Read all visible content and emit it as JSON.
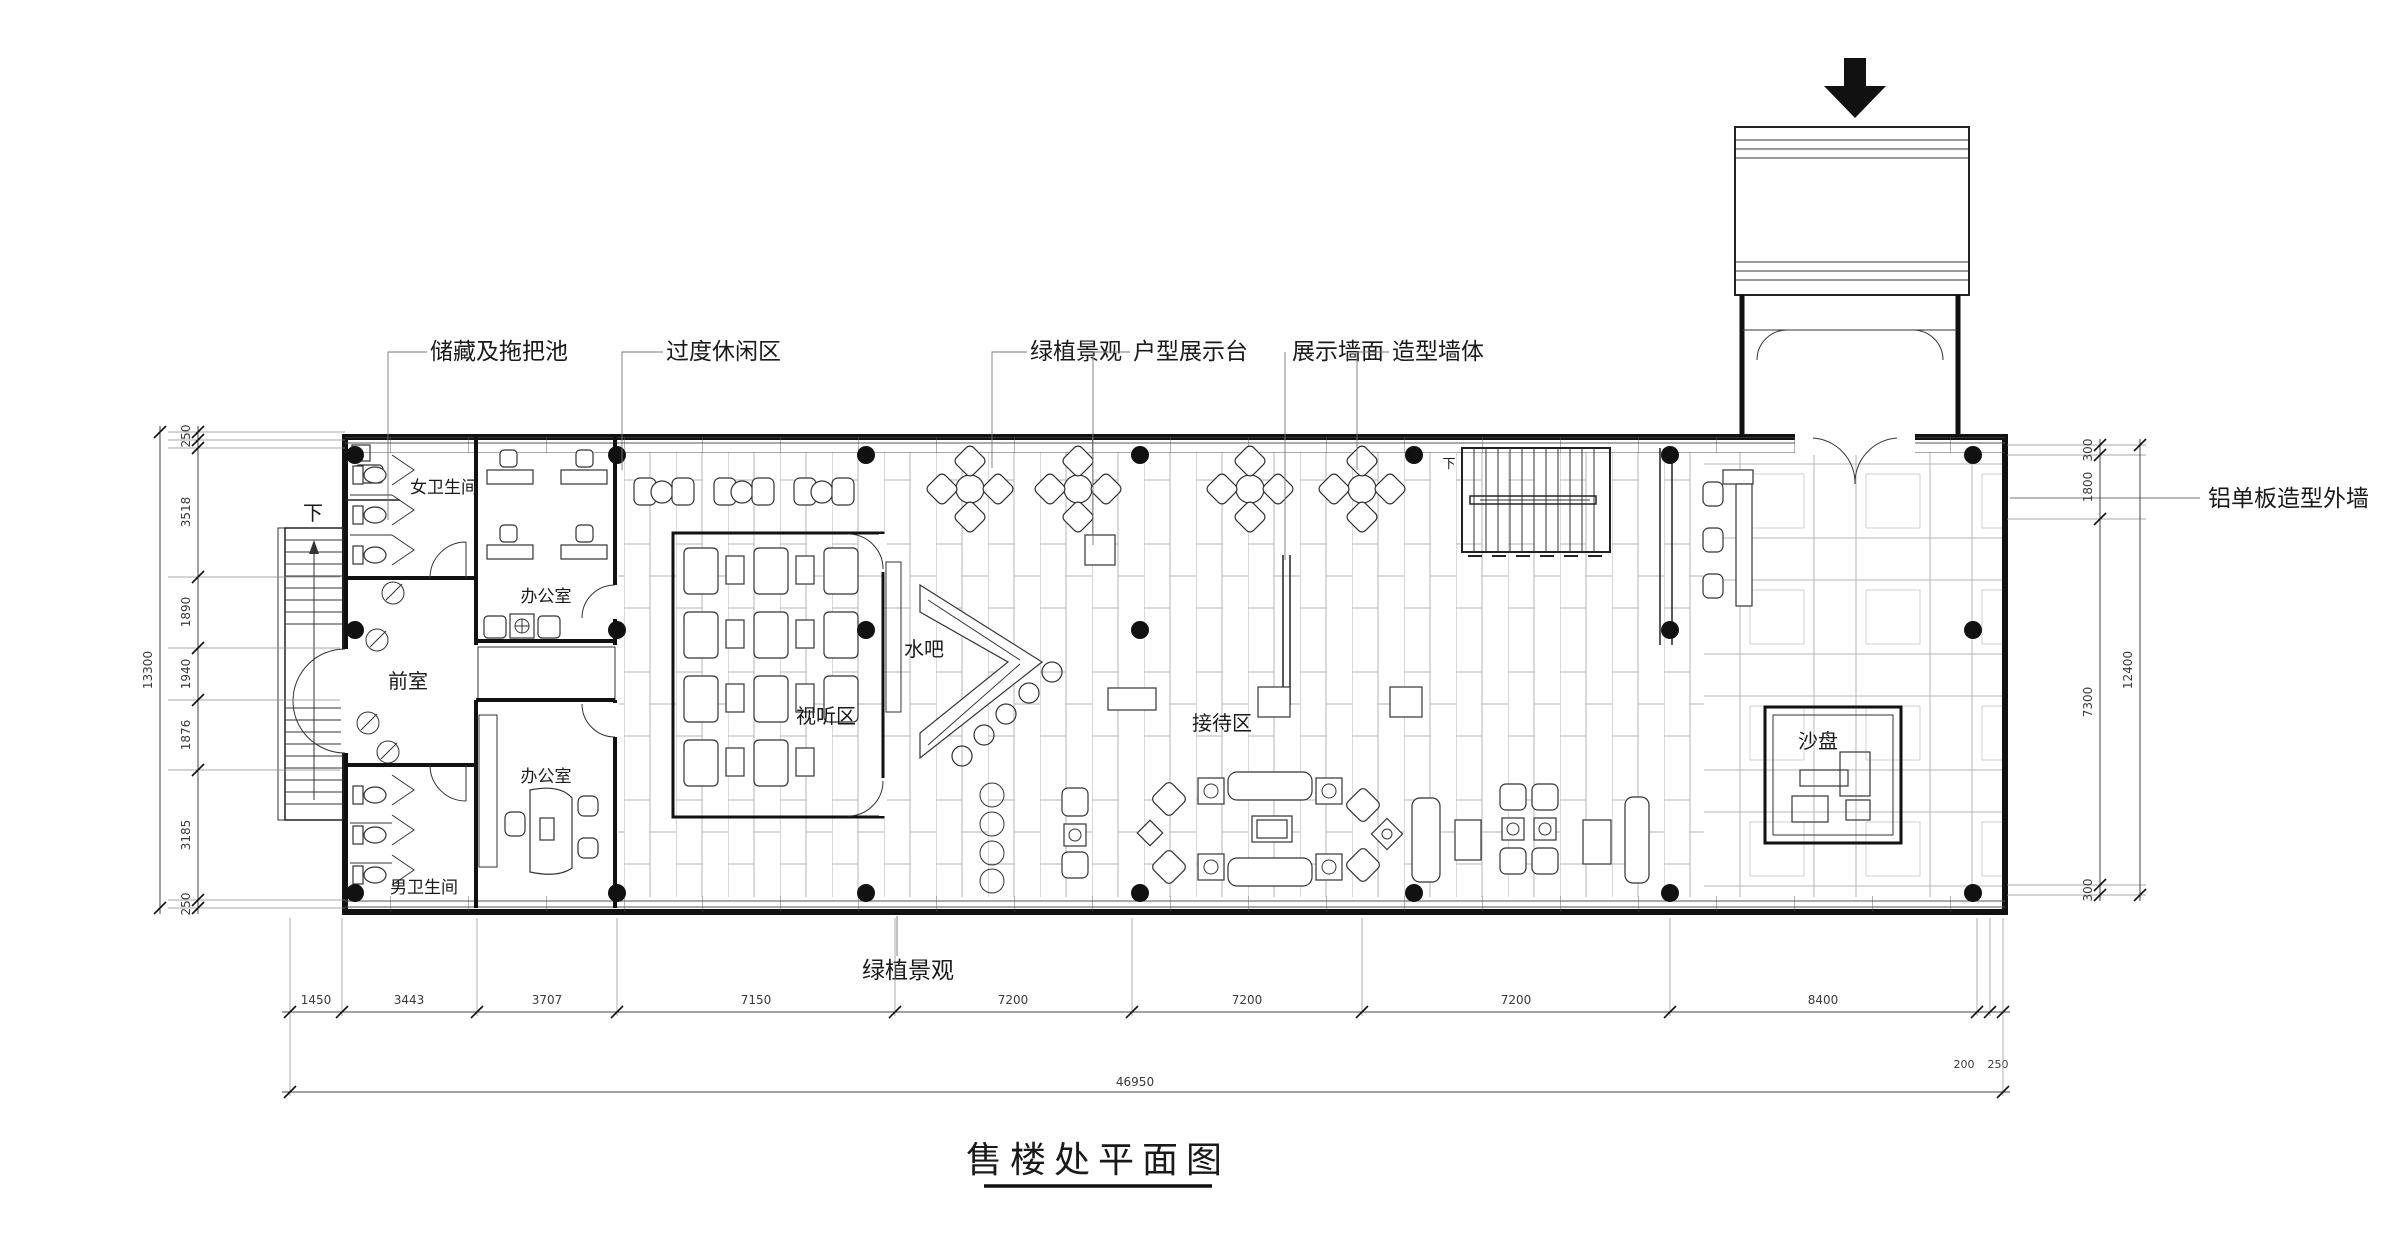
{
  "drawing": {
    "title": "售楼处平面图",
    "rooms": {
      "women_wc": "女卫生间",
      "office_top": "办公室",
      "anteroom": "前室",
      "office_bottom": "办公室",
      "men_wc": "男卫生间",
      "av_area": "视听区",
      "water_bar": "水吧",
      "reception": "接待区",
      "sand_table": "沙盘"
    },
    "callouts": {
      "storage": "储藏及拖把池",
      "leisure": "过度休闲区",
      "plants_top": "绿植景观",
      "unit_display": "户型展示台",
      "display_wall": "展示墙面",
      "feature_wall": "造型墙体",
      "exterior_wall": "铝单板造型外墙",
      "plants_bottom": "绿植景观"
    },
    "stairs": {
      "down_left": "下",
      "down_top": "下"
    },
    "dims": {
      "bottom": [
        "1450",
        "3443",
        "3707",
        "7150",
        "7200",
        "7200",
        "7200",
        "8400",
        "200",
        "250"
      ],
      "bottom_total": "46950",
      "left": [
        "250",
        "3518",
        "1890",
        "1940",
        "1876",
        "3185",
        "250"
      ],
      "left_total": "13300",
      "right": [
        "300",
        "1800",
        "7300",
        "300"
      ],
      "right_total": "12400"
    }
  }
}
